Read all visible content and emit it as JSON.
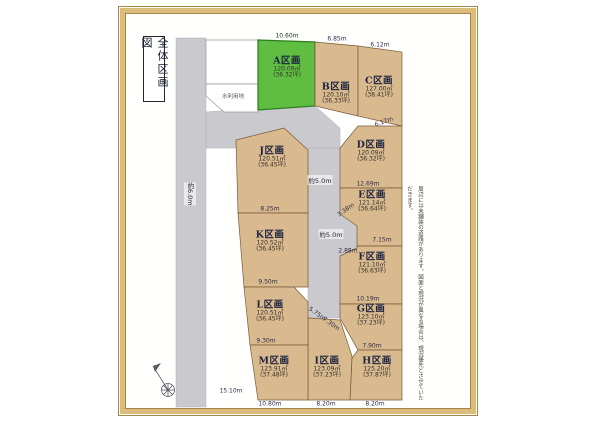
{
  "page": {
    "title": "全体区画図",
    "reserved_area": "水利用地",
    "disclaimer": "周辺には未舗装の道路があります。図面と現況が異なる場合は、現況優先とさせていただきます。"
  },
  "roads": {
    "left_width": "約6.0m",
    "mid_upper_width": "約5.0m",
    "mid_lower_width": "約5.0m"
  },
  "lots": [
    {
      "id": "A",
      "name": "A区画",
      "area": "120.09㎡",
      "tsubo": "(36.32坪)",
      "highlighted": true
    },
    {
      "id": "B",
      "name": "B区画",
      "area": "120.10㎡",
      "tsubo": "(36.33坪)",
      "highlighted": false
    },
    {
      "id": "C",
      "name": "C区画",
      "area": "127.00㎡",
      "tsubo": "(38.41坪)",
      "highlighted": false
    },
    {
      "id": "D",
      "name": "D区画",
      "area": "120.09㎡",
      "tsubo": "(36.32坪)",
      "highlighted": false
    },
    {
      "id": "E",
      "name": "E区画",
      "area": "121.14㎡",
      "tsubo": "(36.64坪)",
      "highlighted": false
    },
    {
      "id": "F",
      "name": "F区画",
      "area": "121.10㎡",
      "tsubo": "(36.63坪)",
      "highlighted": false
    },
    {
      "id": "G",
      "name": "G区画",
      "area": "123.10㎡",
      "tsubo": "(37.23坪)",
      "highlighted": false
    },
    {
      "id": "H",
      "name": "H区画",
      "area": "125.20㎡",
      "tsubo": "(37.87坪)",
      "highlighted": false
    },
    {
      "id": "I",
      "name": "I区画",
      "area": "123.09㎡",
      "tsubo": "(37.23坪)",
      "highlighted": false
    },
    {
      "id": "J",
      "name": "J区画",
      "area": "120.51㎡",
      "tsubo": "(36.45坪)",
      "highlighted": false
    },
    {
      "id": "K",
      "name": "K区画",
      "area": "120.52㎡",
      "tsubo": "(36.45坪)",
      "highlighted": false
    },
    {
      "id": "L",
      "name": "L区画",
      "area": "120.51㎡",
      "tsubo": "(36.45坪)",
      "highlighted": false
    },
    {
      "id": "M",
      "name": "M区画",
      "area": "123.91㎡",
      "tsubo": "(37.48坪)",
      "highlighted": false
    }
  ],
  "dims": [
    "10.60m",
    "6.85m",
    "6.12m",
    "6.17m",
    "12.69m",
    "7.15m",
    "3.38m",
    "2.88m",
    "10.19m",
    "7.90m",
    "8.25m",
    "9.50m",
    "9.30m",
    "10.80m",
    "8.20m",
    "8.20m",
    "15.10m",
    "5.75m",
    "7.30m"
  ],
  "colors": {
    "highlight_green": "#5fbe41",
    "lot_tan": "#d9b98e",
    "road_gray": "#c9c9ce",
    "frame_gold": "#dcbc7a"
  }
}
